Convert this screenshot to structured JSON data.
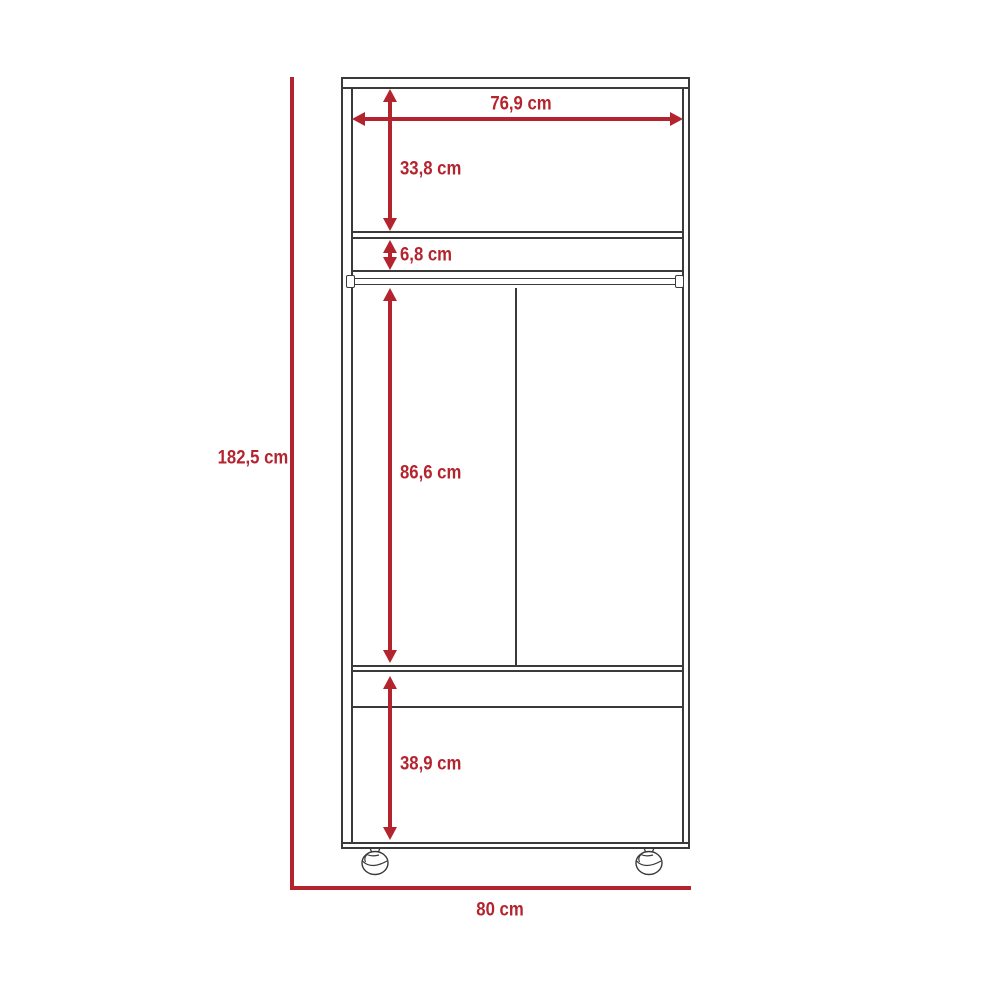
{
  "diagram": {
    "type": "furniture-dimension-diagram",
    "subject": "two-door wardrobe with upper shelf, hanging rod, drawer and caster wheels (front elevation)",
    "unit": "cm",
    "colors": {
      "dimension_red": "#b3242f",
      "outline": "#3a3a3a",
      "background": "#ffffff"
    },
    "dimensions": {
      "total_height": {
        "label": "182,5 cm",
        "value": 182.5,
        "orientation": "vertical",
        "measures": "overall height including casters"
      },
      "total_width": {
        "label": "80 cm",
        "value": 80,
        "orientation": "horizontal",
        "measures": "overall width"
      },
      "inner_width": {
        "label": "76,9 cm",
        "value": 76.9,
        "orientation": "horizontal",
        "measures": "interior width"
      },
      "top_section_height": {
        "label": "33,8 cm",
        "value": 33.8,
        "orientation": "vertical",
        "measures": "upper open compartment height"
      },
      "rod_gap_height": {
        "label": "6,8 cm",
        "value": 6.8,
        "orientation": "vertical",
        "measures": "gap between shelf and hanging rod"
      },
      "hanging_section_height": {
        "label": "86,6 cm",
        "value": 86.6,
        "orientation": "vertical",
        "measures": "hanging compartment height"
      },
      "bottom_section_height": {
        "label": "38,9 cm",
        "value": 38.9,
        "orientation": "vertical",
        "measures": "bottom compartment height"
      }
    }
  }
}
